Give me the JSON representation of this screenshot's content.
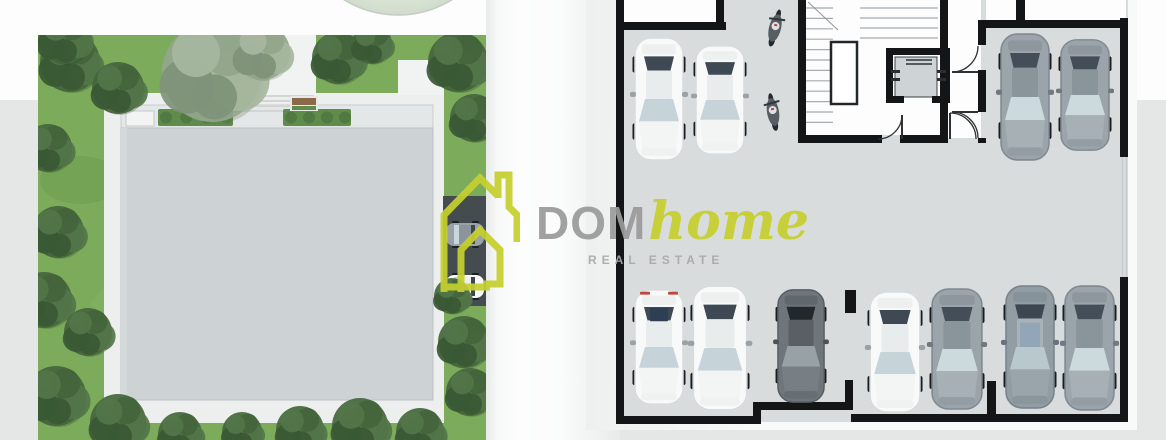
{
  "canvas": {
    "w": 1166,
    "h": 440,
    "bg_top": "#fdfdfd",
    "bg_bottom": "#e5e6e6",
    "bg_split_y": 100
  },
  "spine": {
    "x": 486,
    "w": 134
  },
  "circle_fragment": {
    "cx": 398,
    "cy": -88,
    "r": 103,
    "fill_inner": "#eef3ea",
    "fill_outer": "#cfdccb",
    "rim": "#c5cbc5"
  },
  "logo": {
    "dom": "DOM",
    "home": "home",
    "subtitle": "REAL ESTATE",
    "green": "#c6d02f",
    "gray": "#9b9b9b",
    "subtitle_gray": "#a9a9a9"
  },
  "site_plan": {
    "clip": [
      38,
      35,
      448,
      405
    ],
    "colors": {
      "grass": "#7cab5b",
      "walkway": "#edefef",
      "path": "#f1f2f2",
      "parapet": "#e4e7e7",
      "parapet_edge": "#c9cdcd",
      "roof": "#cdd2d4",
      "roof_edge": "#bcc2c4",
      "planter": "#5f8c4a",
      "driveway": "#454c50",
      "step": "#d2d5d3",
      "bench_frame": "#e7e9e7",
      "bench_wood": "#8b6a4b",
      "ac": "#f2f3f3"
    },
    "walkway": [
      104,
      93,
      340,
      330
    ],
    "entrance_path": [
      236,
      35,
      80,
      60
    ],
    "side_path": [
      398,
      60,
      46,
      35
    ],
    "parapet": [
      121,
      105,
      312,
      25
    ],
    "roof": [
      121,
      128,
      312,
      272
    ],
    "planters": [
      [
        158,
        109,
        75,
        17
      ],
      [
        283,
        109,
        68,
        17
      ]
    ],
    "ac_unit": [
      126,
      111,
      28,
      15
    ],
    "steps": {
      "x1": 238,
      "x2": 314,
      "ys": [
        96,
        101,
        106,
        111
      ]
    },
    "bench": [
      290,
      96,
      28,
      15
    ],
    "driveway": [
      443,
      196,
      43,
      110
    ],
    "driveway_cars": [
      {
        "x": 446,
        "y": 223,
        "w": 38,
        "h": 23,
        "variant": "gray"
      },
      {
        "x": 446,
        "y": 275,
        "w": 38,
        "h": 23,
        "variant": "white"
      }
    ],
    "grass_patches": [
      [
        260,
        260,
        70,
        40,
        "#9cc47b",
        0.22
      ],
      [
        140,
        310,
        50,
        30,
        "#9cc47b",
        0.18
      ],
      [
        380,
        360,
        40,
        26,
        "#9cc47b",
        0.18
      ],
      [
        80,
        180,
        40,
        24,
        "#5a8a44",
        0.22
      ]
    ],
    "trees": [
      [
        70,
        62,
        30,
        "dark"
      ],
      [
        118,
        88,
        26,
        "dark"
      ],
      [
        64,
        38,
        26,
        "dark"
      ],
      [
        48,
        148,
        24,
        "dark"
      ],
      [
        212,
        72,
        50,
        "olive"
      ],
      [
        262,
        52,
        28,
        "olive"
      ],
      [
        338,
        58,
        26,
        "dark"
      ],
      [
        372,
        44,
        20,
        "dark"
      ],
      [
        458,
        62,
        30,
        "dark"
      ],
      [
        474,
        118,
        24,
        "dark"
      ],
      [
        58,
        232,
        26,
        "dark"
      ],
      [
        44,
        300,
        28,
        "dark"
      ],
      [
        88,
        332,
        24,
        "dark"
      ],
      [
        56,
        396,
        30,
        "dark"
      ],
      [
        118,
        422,
        28,
        "dark"
      ],
      [
        180,
        434,
        22,
        "dark"
      ],
      [
        242,
        432,
        20,
        "dark"
      ],
      [
        300,
        430,
        24,
        "dark"
      ],
      [
        360,
        426,
        28,
        "dark"
      ],
      [
        420,
        432,
        24,
        "dark"
      ],
      [
        464,
        342,
        26,
        "dark"
      ],
      [
        470,
        392,
        24,
        "dark"
      ],
      [
        452,
        296,
        18,
        "dark"
      ]
    ],
    "tree_tones": {
      "dark": [
        "#44653c",
        "#527549",
        "#3a5834",
        "#2e452b"
      ],
      "olive": [
        "#93a68c",
        "#a6b79e",
        "#7e9278",
        "#6e8168"
      ]
    }
  },
  "floor_plan": {
    "clip": [
      586,
      0,
      551,
      430
    ],
    "colors": {
      "wall": "#131517",
      "floor": "#d9dcdd",
      "page_l": "#eef0f0",
      "page_r": "#f8f9f9",
      "room": "#fdfdfd",
      "tread": "#a6acaf",
      "diag": "#90969a",
      "door": "#2e3236",
      "opening": "#c6cacb",
      "landing_stroke": "#232629",
      "elev_car": "#ced3d5",
      "elev_stroke": "#3a3f42",
      "elev_detail": "#2a2e31"
    },
    "floor_rect": [
      620,
      0,
      508,
      422
    ],
    "rooms": [
      [
        624,
        0,
        94,
        22
      ],
      [
        806,
        0,
        136,
        135
      ],
      [
        948,
        0,
        33,
        138
      ],
      [
        986,
        0,
        140,
        20
      ]
    ],
    "walls": [
      [
        616,
        0,
        8,
        424
      ],
      [
        616,
        416,
        141,
        8
      ],
      [
        753,
        402,
        8,
        22
      ],
      [
        753,
        402,
        98,
        8
      ],
      [
        845,
        380,
        8,
        30
      ],
      [
        851,
        414,
        146,
        8
      ],
      [
        987,
        381,
        9,
        41
      ],
      [
        994,
        414,
        134,
        8
      ],
      [
        1120,
        18,
        8,
        139
      ],
      [
        1120,
        277,
        8,
        145
      ],
      [
        616,
        22,
        110,
        8
      ],
      [
        716,
        0,
        8,
        30
      ],
      [
        978,
        20,
        144,
        8
      ],
      [
        1016,
        0,
        9,
        26
      ],
      [
        798,
        0,
        8,
        143
      ],
      [
        798,
        135,
        84,
        8
      ],
      [
        900,
        135,
        48,
        8
      ],
      [
        940,
        0,
        8,
        143
      ],
      [
        978,
        25,
        8,
        20
      ],
      [
        978,
        70,
        8,
        42
      ],
      [
        978,
        138,
        8,
        5
      ],
      [
        886,
        48,
        64,
        7
      ],
      [
        886,
        48,
        7,
        55
      ],
      [
        943,
        48,
        7,
        55
      ],
      [
        886,
        96,
        18,
        7
      ],
      [
        932,
        96,
        18,
        7
      ],
      [
        845,
        290,
        11,
        23
      ]
    ],
    "stairs": {
      "tread_x1": 806,
      "tread_x2": 833,
      "tread_y0": 8,
      "tread_step": 10.4,
      "tread_count": 12,
      "upper_x1": 860,
      "upper_x2": 938,
      "upper_ys": [
        8,
        18,
        28,
        38
      ],
      "diag": [
        808,
        2,
        838,
        30
      ],
      "landing": [
        831,
        42,
        26,
        62
      ]
    },
    "elevator": {
      "car": [
        895,
        57,
        42,
        40
      ],
      "sills": [
        [
          906,
          59,
          26,
          2
        ],
        [
          906,
          63,
          26,
          2
        ]
      ],
      "brackets": [
        [
          891,
          70,
          9,
          3
        ],
        [
          891,
          78,
          9,
          3
        ],
        [
          937,
          70,
          9,
          3
        ],
        [
          937,
          78,
          9,
          3
        ]
      ]
    },
    "doors": [
      {
        "arc": "M 952 72 A 26 26 0 0 0 978 46",
        "leaf": "M 978 72 L 952 72"
      },
      {
        "arc": "M 952 112 A 26 26 0 0 1 978 138",
        "leaf": "M 978 112 L 952 112"
      },
      {
        "arc": "M 878 139 A 24 24 0 0 0 902 115",
        "leaf": "M 902 139 L 902 115"
      },
      {
        "arc": "M 976 139 A 26 26 0 0 0 950 113",
        "leaf": "M 950 139 L 950 113"
      }
    ],
    "opening_lines": [
      [
        1122.5,
        157,
        1122.5,
        277
      ],
      [
        1126.5,
        157,
        1126.5,
        277
      ]
    ],
    "cars": [
      {
        "x": 633,
        "y": 36,
        "w": 52,
        "h": 126,
        "variant": "white"
      },
      {
        "x": 694,
        "y": 44,
        "w": 52,
        "h": 112,
        "variant": "white"
      },
      {
        "x": 999,
        "y": 32,
        "w": 52,
        "h": 130,
        "variant": "gray"
      },
      {
        "x": 1059,
        "y": 38,
        "w": 52,
        "h": 114,
        "variant": "gray"
      },
      {
        "x": 633,
        "y": 288,
        "w": 52,
        "h": 118,
        "variant": "white-sunroof"
      },
      {
        "x": 691,
        "y": 284,
        "w": 58,
        "h": 128,
        "variant": "white"
      },
      {
        "x": 776,
        "y": 288,
        "w": 50,
        "h": 116,
        "variant": "darkgray"
      },
      {
        "x": 868,
        "y": 290,
        "w": 54,
        "h": 124,
        "variant": "white"
      },
      {
        "x": 930,
        "y": 287,
        "w": 54,
        "h": 124,
        "variant": "gray"
      },
      {
        "x": 1004,
        "y": 284,
        "w": 52,
        "h": 126,
        "variant": "gray-suv"
      },
      {
        "x": 1063,
        "y": 284,
        "w": 53,
        "h": 128,
        "variant": "gray"
      }
    ],
    "car_palettes": {
      "white": {
        "body": "#f8f9f9",
        "stroke": "#d8dbdc",
        "deck": "#eef0f0",
        "winDark": "#3e4953",
        "roof": "#e9eced",
        "winLight": "#c6d4d9",
        "hood": "#f3f5f5",
        "mirror": "#9aa2a6",
        "bumper": "#f0f2f2"
      },
      "gray": {
        "body": "#9aa4aa",
        "stroke": "#7f898f",
        "deck": "#8d979d",
        "winDark": "#434e59",
        "roof": "#8a959b",
        "winLight": "#ccdade",
        "hood": "#a7b0b5",
        "mirror": "#6f797f",
        "bumper": "#939da3"
      },
      "darkgray": {
        "body": "#6e767b",
        "stroke": "#575e63",
        "deck": "#60686d",
        "winDark": "#23282d",
        "roof": "#595f64",
        "winLight": "#97a1a6",
        "hood": "#787f84",
        "mirror": "#4c5357",
        "bumper": "#676f74"
      },
      "white-sunroof": {
        "body": "#f8f9f9",
        "stroke": "#d8dbdc",
        "deck": "#eef0f0",
        "winDark": "#3e4953",
        "roof": "#e9eced",
        "winLight": "#c6d4d9",
        "hood": "#f3f5f5",
        "mirror": "#9aa2a6",
        "bumper": "#f0f2f2",
        "sunroof": "#2e3e54",
        "tail": "#c2453c"
      },
      "gray-suv": {
        "body": "#929da3",
        "stroke": "#77828a",
        "deck": "#87939a",
        "winDark": "#3d4751",
        "roof": "#a7b3b9",
        "winLight": "#b9c8cd",
        "hood": "#9aa5ab",
        "mirror": "#68727a",
        "bumper": "#8b969c",
        "interior": "#8fa3b6"
      }
    },
    "motorcycles": [
      {
        "x": 775,
        "y": 28,
        "rot": 14
      },
      {
        "x": 773,
        "y": 112,
        "rot": -9
      }
    ]
  }
}
